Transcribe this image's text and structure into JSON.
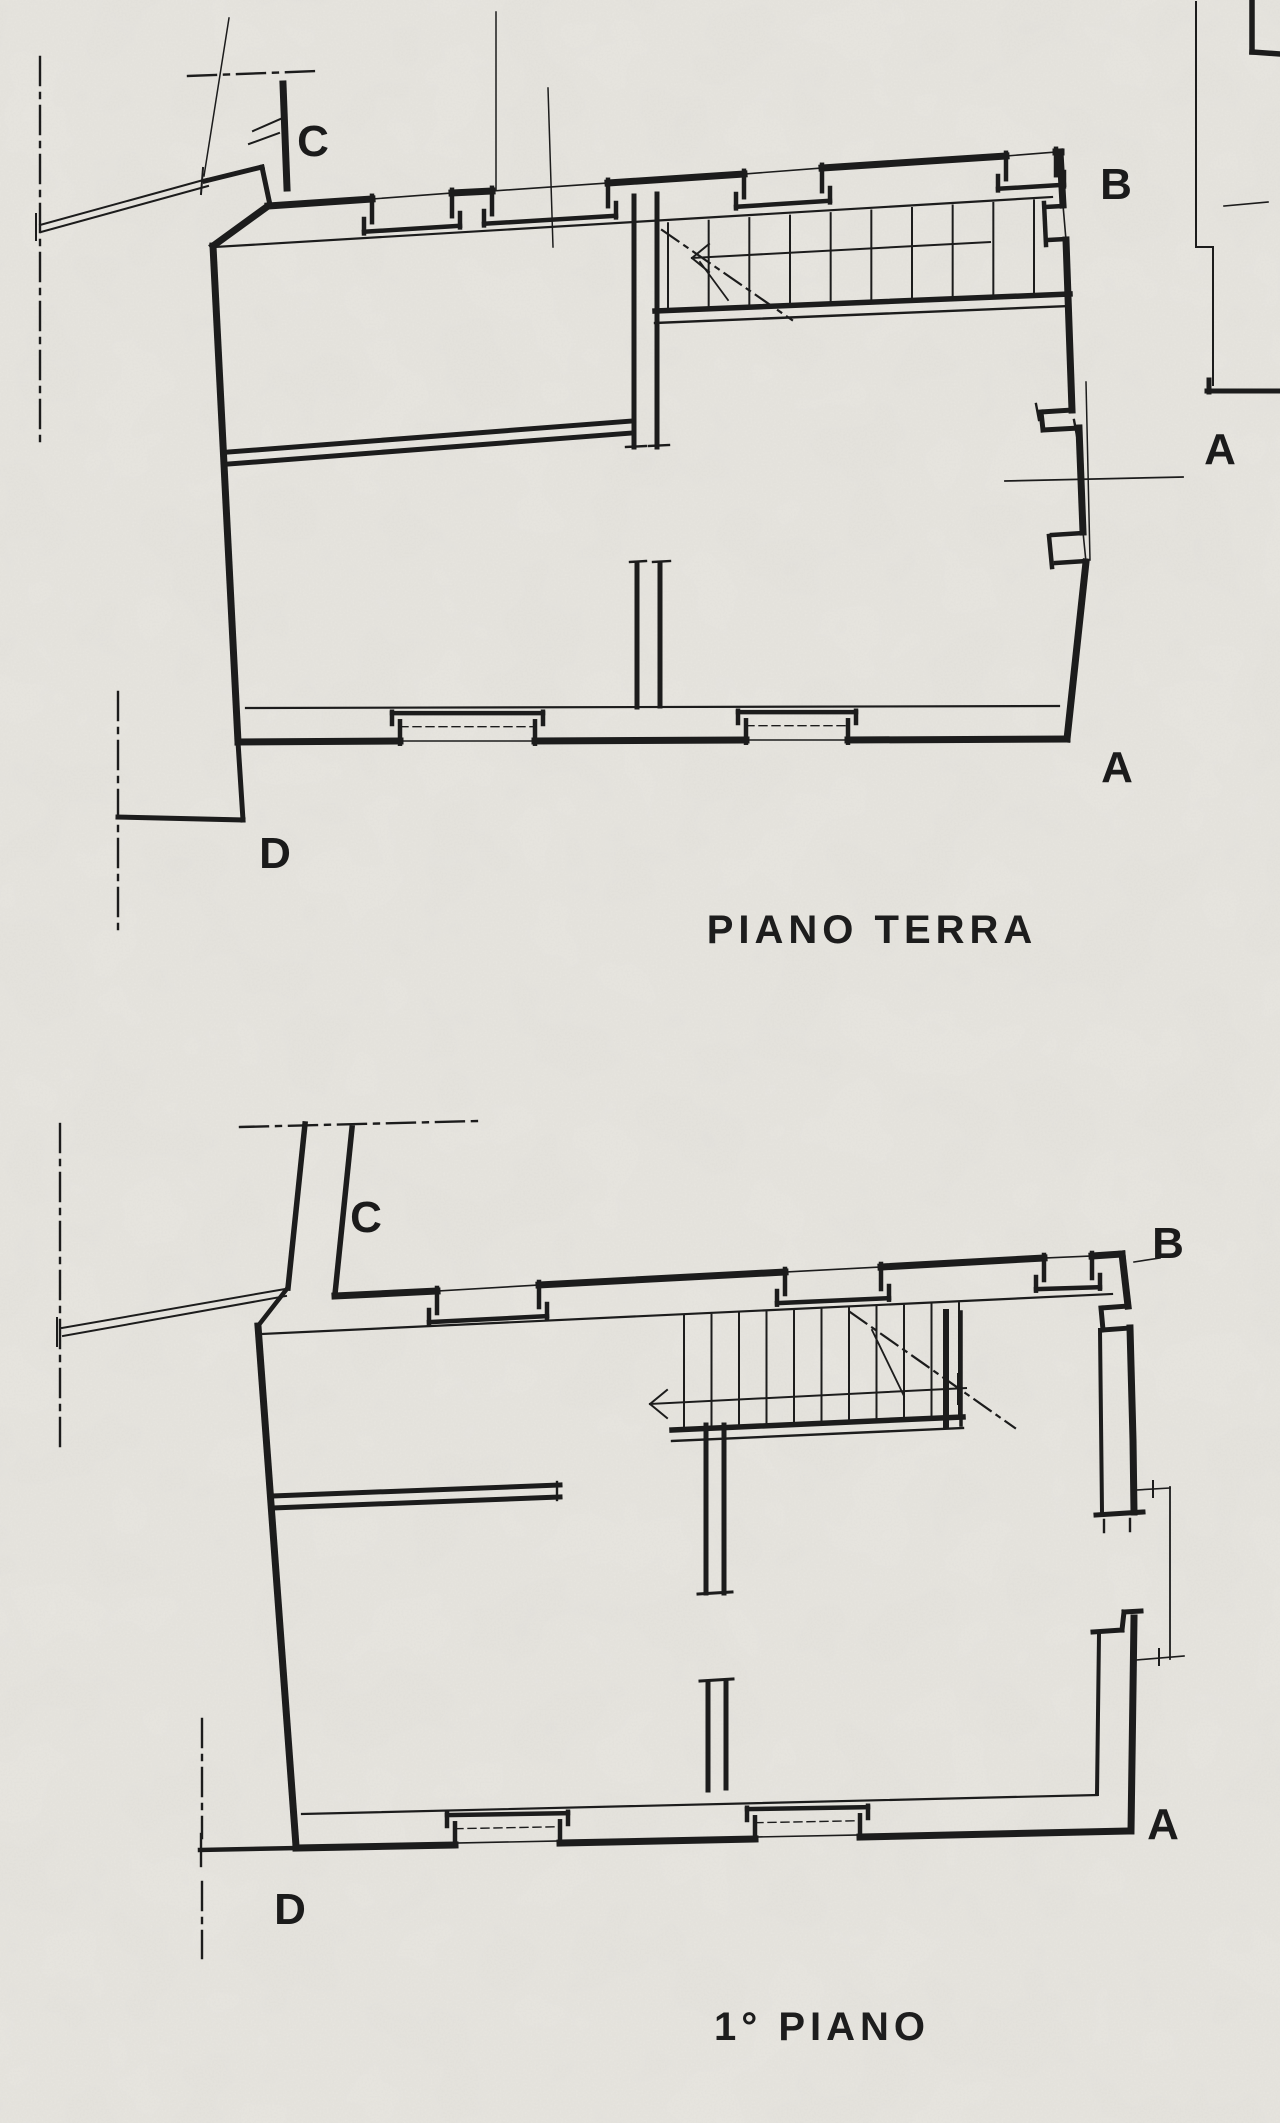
{
  "colors": {
    "paper": "#e9e7e1",
    "ink": "#1c1c1c"
  },
  "ground_floor": {
    "title": "PIANO TERRA",
    "labels": {
      "c": "C",
      "b": "B",
      "a_side": "A",
      "a_corner": "A",
      "d": "D"
    }
  },
  "first_floor": {
    "title": "1° PIANO",
    "labels": {
      "c": "C",
      "b": "B",
      "a": "A",
      "d": "D"
    }
  }
}
